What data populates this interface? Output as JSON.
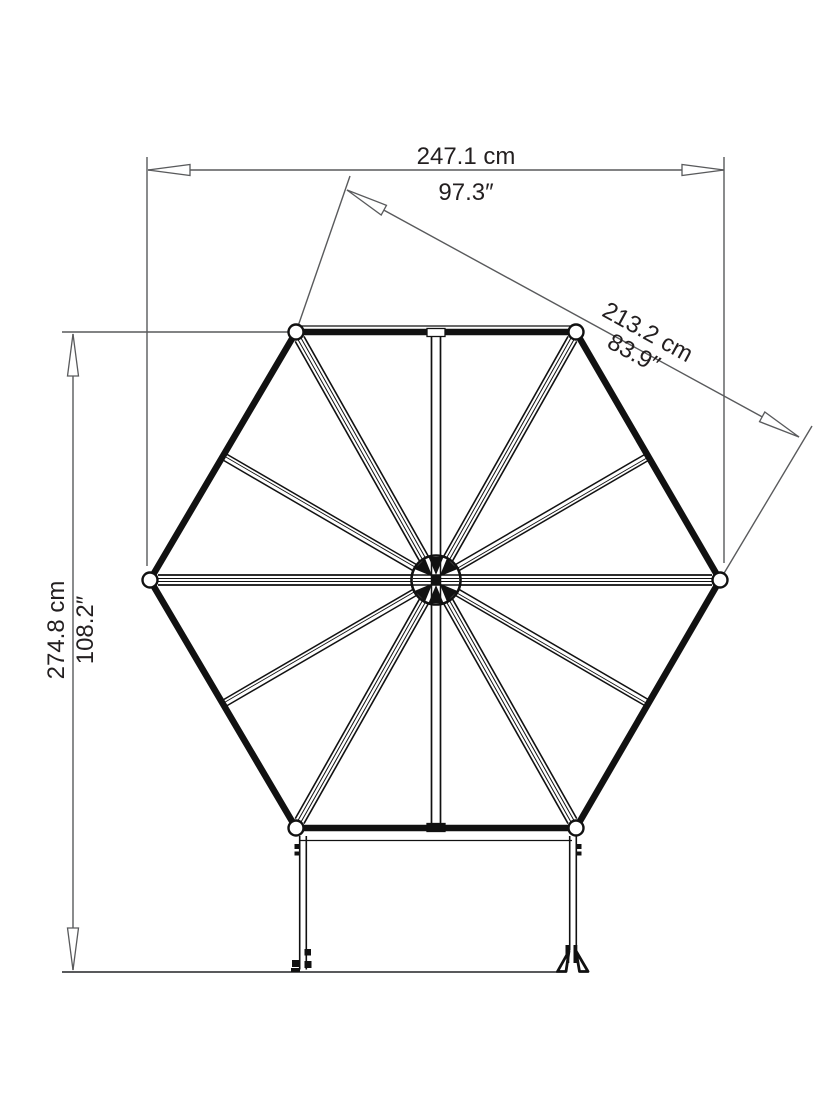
{
  "diagram": {
    "title": "hexagonal-greenhouse-top-view-dimensions",
    "dims": {
      "width": {
        "cm": "247.1 cm",
        "in": "97.3″"
      },
      "diagonal": {
        "cm": "213.2 cm",
        "in": "83.9″"
      },
      "height": {
        "cm": "274.8 cm",
        "in": "108.2″"
      }
    },
    "colors": {
      "structure": "#111111",
      "dimension_lines": "#595a5c",
      "text": "#231f20",
      "background": "#ffffff"
    }
  }
}
